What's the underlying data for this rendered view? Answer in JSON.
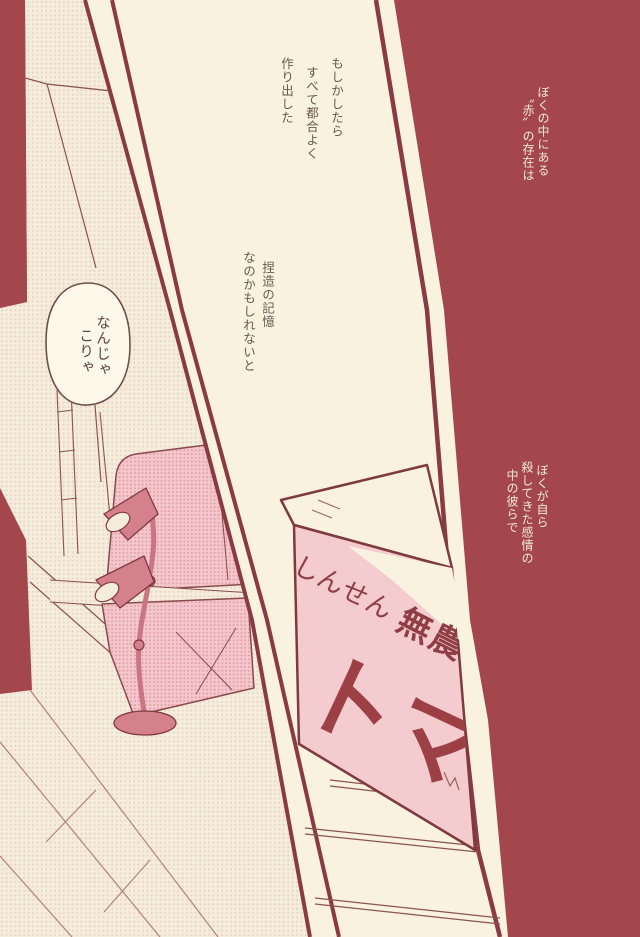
{
  "page": {
    "kind": "manga-page",
    "colors": {
      "background_maroon": "#a3474d",
      "paper_cream": "#f9f2df",
      "panel_border": "#8a3a42",
      "scene_base": "#f5eddb",
      "halftone_dot": "#e0b0ac",
      "sofa_pink": "#f3c7cc",
      "sofa_dot": "#e08e9e",
      "lamp_pink": "#d5808d",
      "box_pink": "#f4cbcf",
      "box_ink": "#9c4046",
      "white_ink": "#f2e8d4",
      "brown_ink": "#6b584e"
    }
  },
  "narration": {
    "right_top": {
      "lines": [
        "ぼくの中にある",
        "〝赤〟の存在は"
      ]
    },
    "right_mid": {
      "lines": [
        "ぼくが自ら",
        "殺してきた感情の",
        "中の彼らで"
      ]
    },
    "monologue_top": {
      "lines": [
        "もしかしたら",
        "すべて都合よく",
        "作り出した"
      ]
    },
    "monologue_mid": {
      "lines": [
        "捏造の記憶",
        "なのかもしれないと"
      ]
    }
  },
  "speech_bubble": {
    "lines": [
      "なんじゃ",
      "こりゃ"
    ]
  },
  "box": {
    "label_hiragana": "しんせん",
    "label_kanji": "無農",
    "label_large": "トマ"
  }
}
